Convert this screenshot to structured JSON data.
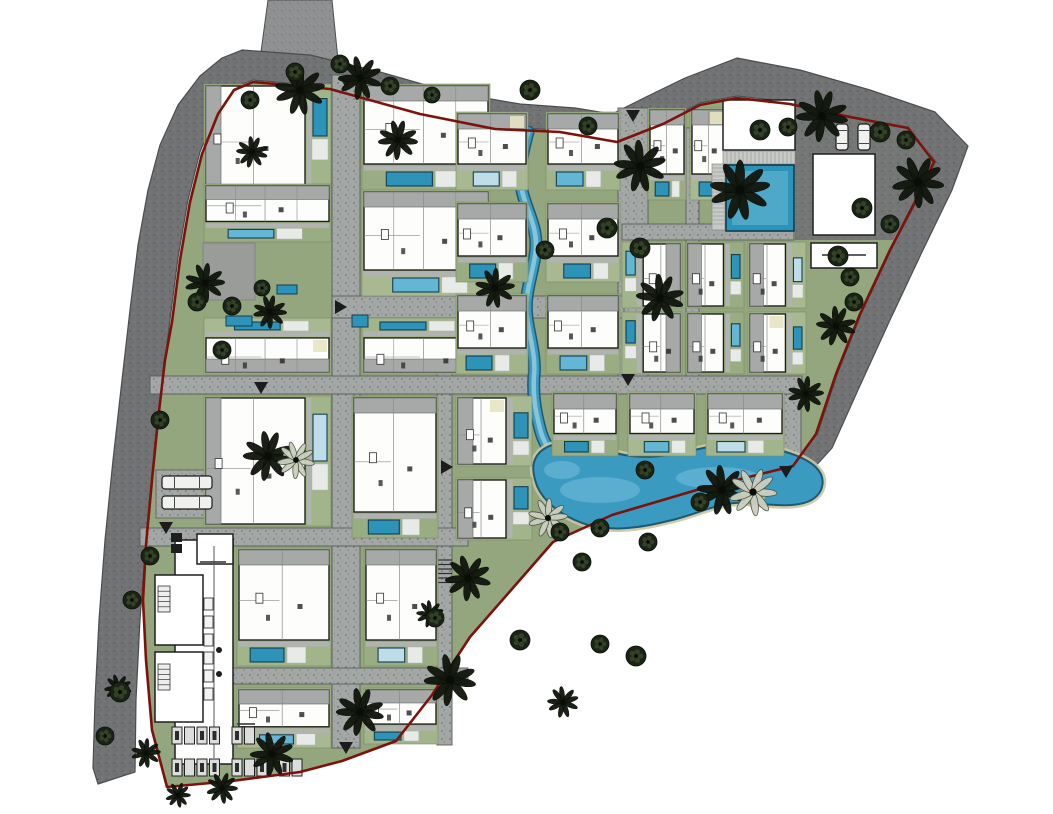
{
  "canvas": {
    "w": 1053,
    "h": 814
  },
  "palette": {
    "bg": "#ffffff",
    "ring_base": "#717374",
    "ring_dot1": "#5a5c5d",
    "ring_dot2": "#818384",
    "ring_edge": "#4b4d4e",
    "entry_base": "#8f9192",
    "entry_dot": "#7b7d7e",
    "road_base": "#a3a7a5",
    "road_dot1": "#6d7170",
    "road_dot2": "#8e928f",
    "road_edge": "#5a5d5b",
    "green": "#93a67e",
    "yard1": "#a2b489",
    "yard2": "#9aad82",
    "yard3": "#a8b890",
    "boundary_red": "#7d120c",
    "villa_fill": "#fdfdfb",
    "villa_edge": "#1f1f1f",
    "wall": "#8a8a8a",
    "furniture": "#2f2f2f",
    "roof": "#a6a9a7",
    "roof_line": "#6e7270",
    "terrace": "#b0b3b0",
    "terrace_tick": "#8a8d89",
    "pool_deep": "#2e93b8",
    "pool_mid": "#64b7d4",
    "pool_pale": "#bfdde8",
    "pool_edge": "#123f54",
    "deck": "#e7eae6",
    "beige": "#e8e3c2",
    "stream_edge": "#1a5a74",
    "stream": "#3b9ac0",
    "stream_hi": "#8fcade",
    "sand": "#cdc5a2",
    "lagoon_hi": "#77bfdb",
    "island_green": "#8fa377",
    "tree_dark": "#12170e",
    "tree_stroke": "#060904",
    "tree_speck": "#39492c",
    "palm_light": "#c9cfbf",
    "palm_light_edge": "#4a5240",
    "patch_gray": "#9a9c99",
    "white": "#ffffff",
    "car_fill": "#f0f0ef",
    "car_edge": "#1c1c1c",
    "arrow": "#1c1c1c",
    "label_ink": "#3a3a3a",
    "stall_fill": "#dcdedb",
    "stall_edge": "#222222",
    "stall_car": "#2c2c2c"
  },
  "perimeter": {
    "ring": [
      [
        98,
        784
      ],
      [
        93,
        768
      ],
      [
        95,
        700
      ],
      [
        99,
        620
      ],
      [
        105,
        540
      ],
      [
        113,
        460
      ],
      [
        122,
        380
      ],
      [
        130,
        310
      ],
      [
        138,
        245
      ],
      [
        148,
        190
      ],
      [
        160,
        145
      ],
      [
        178,
        105
      ],
      [
        200,
        76
      ],
      [
        222,
        58
      ],
      [
        242,
        50
      ],
      [
        310,
        55
      ],
      [
        380,
        72
      ],
      [
        450,
        92
      ],
      [
        520,
        104
      ],
      [
        575,
        108
      ],
      [
        612,
        114
      ],
      [
        648,
        96
      ],
      [
        685,
        78
      ],
      [
        737,
        58
      ],
      [
        800,
        70
      ],
      [
        870,
        90
      ],
      [
        935,
        112
      ],
      [
        968,
        146
      ],
      [
        952,
        190
      ],
      [
        922,
        252
      ],
      [
        890,
        320
      ],
      [
        858,
        390
      ],
      [
        832,
        448
      ],
      [
        812,
        470
      ],
      [
        795,
        464
      ],
      [
        818,
        432
      ],
      [
        838,
        372
      ],
      [
        862,
        312
      ],
      [
        892,
        248
      ],
      [
        920,
        195
      ],
      [
        936,
        162
      ],
      [
        908,
        126
      ],
      [
        850,
        115
      ],
      [
        790,
        102
      ],
      [
        737,
        96
      ],
      [
        700,
        103
      ],
      [
        663,
        122
      ],
      [
        617,
        140
      ],
      [
        560,
        130
      ],
      [
        495,
        127
      ],
      [
        420,
        112
      ],
      [
        330,
        87
      ],
      [
        253,
        80
      ],
      [
        232,
        88
      ],
      [
        216,
        112
      ],
      [
        200,
        152
      ],
      [
        188,
        200
      ],
      [
        178,
        258
      ],
      [
        170,
        320
      ],
      [
        161,
        392
      ],
      [
        154,
        460
      ],
      [
        146,
        540
      ],
      [
        140,
        620
      ],
      [
        136,
        700
      ],
      [
        135,
        772
      ]
    ],
    "entry": [
      [
        268,
        0
      ],
      [
        332,
        0
      ],
      [
        340,
        80
      ],
      [
        258,
        74
      ]
    ],
    "amenity_patch": [
      [
        795,
        96
      ],
      [
        910,
        124
      ],
      [
        936,
        163
      ],
      [
        893,
        240
      ],
      [
        795,
        240
      ]
    ],
    "utility_patch": [
      203,
      243,
      52,
      57
    ],
    "parking_pad": [
      156,
      470,
      60,
      48
    ]
  },
  "boundary": [
    [
      253,
      82
    ],
    [
      330,
      89
    ],
    [
      420,
      114
    ],
    [
      495,
      129
    ],
    [
      560,
      132
    ],
    [
      617,
      142
    ],
    [
      663,
      124
    ],
    [
      700,
      105
    ],
    [
      737,
      98
    ],
    [
      790,
      104
    ],
    [
      850,
      117
    ],
    [
      908,
      128
    ],
    [
      934,
      162
    ],
    [
      918,
      196
    ],
    [
      890,
      250
    ],
    [
      860,
      314
    ],
    [
      836,
      374
    ],
    [
      816,
      434
    ],
    [
      793,
      466
    ],
    [
      700,
      489
    ],
    [
      612,
      515
    ],
    [
      553,
      542
    ],
    [
      512,
      589
    ],
    [
      470,
      637
    ],
    [
      432,
      695
    ],
    [
      396,
      741
    ],
    [
      342,
      761
    ],
    [
      300,
      772
    ],
    [
      232,
      781
    ],
    [
      167,
      787
    ],
    [
      152,
      730
    ],
    [
      146,
      660
    ],
    [
      143,
      600
    ],
    [
      146,
      545
    ],
    [
      152,
      480
    ],
    [
      158,
      420
    ],
    [
      165,
      360
    ],
    [
      172,
      322
    ],
    [
      180,
      260
    ],
    [
      190,
      202
    ],
    [
      202,
      154
    ],
    [
      218,
      114
    ],
    [
      234,
      90
    ]
  ],
  "roads": [
    [
      332,
      75,
      28,
      673
    ],
    [
      618,
      108,
      30,
      270
    ],
    [
      775,
      377,
      26,
      90
    ],
    [
      437,
      85,
      15,
      660
    ],
    [
      686,
      128,
      13,
      250
    ],
    [
      332,
      296,
      292,
      22
    ],
    [
      622,
      224,
      172,
      16
    ],
    [
      150,
      376,
      652,
      18
    ],
    [
      140,
      528,
      328,
      18
    ],
    [
      228,
      668,
      240,
      16
    ]
  ],
  "ladder": {
    "x": 437,
    "y": 560,
    "w": 15,
    "n": 6,
    "step": 4.5
  },
  "stream": {
    "path": "M528,132 C521,158 517,176 524,198 C530,218 539,232 535,256 C531,280 524,296 527,318 C530,340 536,356 534,376 C533,390 534,402 537,416 C540,430 542,438 547,446"
  },
  "lagoon": {
    "path": "M540,452 C558,436 585,444 612,452 C642,461 666,456 694,450 C724,443 756,442 786,452 C812,460 828,472 821,490 C812,509 782,506 752,503 C720,500 700,514 668,521 C636,529 606,532 582,523 C558,514 543,500 537,486 C532,472 531,461 540,452 Z",
    "island": [
      753,
      495,
      11
    ],
    "highlights": [
      [
        600,
        490,
        40,
        13
      ],
      [
        718,
        478,
        42,
        11
      ],
      [
        562,
        470,
        18,
        9
      ]
    ]
  },
  "villas": [
    [
      204,
      84,
      127,
      104,
      "E"
    ],
    [
      204,
      184,
      127,
      58,
      "S"
    ],
    [
      204,
      318,
      127,
      56,
      "N"
    ],
    [
      204,
      396,
      127,
      130,
      "E"
    ],
    [
      362,
      84,
      128,
      106,
      "S"
    ],
    [
      362,
      190,
      128,
      106,
      "S"
    ],
    [
      362,
      318,
      128,
      56,
      "N"
    ],
    [
      352,
      396,
      86,
      142,
      "S"
    ],
    [
      456,
      112,
      72,
      78,
      "S"
    ],
    [
      546,
      112,
      74,
      78,
      "S"
    ],
    [
      456,
      202,
      72,
      80,
      "S"
    ],
    [
      546,
      202,
      74,
      80,
      "S"
    ],
    [
      456,
      294,
      72,
      80,
      "S"
    ],
    [
      546,
      294,
      74,
      80,
      "S"
    ],
    [
      456,
      396,
      76,
      70,
      "E"
    ],
    [
      456,
      478,
      76,
      62,
      "E"
    ],
    [
      552,
      392,
      66,
      64,
      "S"
    ],
    [
      628,
      392,
      68,
      64,
      "S"
    ],
    [
      706,
      392,
      78,
      64,
      "S"
    ],
    [
      648,
      108,
      38,
      92,
      "S"
    ],
    [
      690,
      108,
      38,
      92,
      "S"
    ],
    [
      622,
      242,
      60,
      66,
      "W"
    ],
    [
      686,
      242,
      58,
      66,
      "E"
    ],
    [
      748,
      242,
      58,
      66,
      "E"
    ],
    [
      622,
      312,
      60,
      62,
      "W"
    ],
    [
      686,
      312,
      58,
      62,
      "E"
    ],
    [
      748,
      312,
      58,
      62,
      "E"
    ],
    [
      237,
      548,
      94,
      118,
      "S"
    ],
    [
      364,
      548,
      74,
      118,
      "S"
    ],
    [
      237,
      688,
      94,
      60,
      "S"
    ],
    [
      364,
      688,
      74,
      56,
      "S"
    ]
  ],
  "loose_pools": [
    [
      277,
      285,
      20,
      9
    ],
    [
      226,
      316,
      26,
      10
    ],
    [
      352,
      315,
      16,
      12
    ]
  ],
  "trees": [
    [
      300,
      90,
      24,
      "p"
    ],
    [
      360,
      78,
      21,
      "p"
    ],
    [
      398,
      140,
      19,
      "p"
    ],
    [
      252,
      152,
      15,
      "p"
    ],
    [
      205,
      283,
      19,
      "p"
    ],
    [
      270,
      312,
      16,
      "p"
    ],
    [
      640,
      166,
      25,
      "p"
    ],
    [
      740,
      190,
      29,
      "p"
    ],
    [
      822,
      116,
      25,
      "p"
    ],
    [
      918,
      182,
      25,
      "p"
    ],
    [
      495,
      288,
      19,
      "p"
    ],
    [
      660,
      298,
      23,
      "p"
    ],
    [
      836,
      326,
      19,
      "p"
    ],
    [
      806,
      394,
      17,
      "p"
    ],
    [
      722,
      490,
      24,
      "p"
    ],
    [
      468,
      578,
      22,
      "p"
    ],
    [
      450,
      680,
      25,
      "p"
    ],
    [
      360,
      712,
      23,
      "p"
    ],
    [
      272,
      754,
      21,
      "p"
    ],
    [
      178,
      795,
      12,
      "p"
    ],
    [
      268,
      456,
      24,
      "p"
    ],
    [
      563,
      702,
      15,
      "p"
    ],
    [
      430,
      614,
      13,
      "p"
    ],
    [
      118,
      688,
      13,
      "p"
    ],
    [
      146,
      753,
      14,
      "p"
    ],
    [
      222,
      788,
      15,
      "p"
    ],
    [
      296,
      460,
      18,
      "w"
    ],
    [
      548,
      518,
      19,
      "w"
    ],
    [
      753,
      492,
      23,
      "w"
    ],
    [
      250,
      100,
      9,
      "s"
    ],
    [
      295,
      72,
      9,
      "s"
    ],
    [
      340,
      64,
      9,
      "s"
    ],
    [
      390,
      86,
      9,
      "s"
    ],
    [
      432,
      95,
      8,
      "s"
    ],
    [
      530,
      90,
      10,
      "s"
    ],
    [
      588,
      126,
      9,
      "s"
    ],
    [
      607,
      228,
      10,
      "s"
    ],
    [
      640,
      248,
      10,
      "s"
    ],
    [
      545,
      250,
      9,
      "s"
    ],
    [
      760,
      130,
      10,
      "s"
    ],
    [
      788,
      127,
      9,
      "s"
    ],
    [
      880,
      132,
      10,
      "s"
    ],
    [
      906,
      140,
      9,
      "s"
    ],
    [
      862,
      208,
      10,
      "s"
    ],
    [
      890,
      224,
      9,
      "s"
    ],
    [
      838,
      256,
      10,
      "s"
    ],
    [
      850,
      277,
      9,
      "s"
    ],
    [
      854,
      302,
      9,
      "s"
    ],
    [
      645,
      470,
      9,
      "s"
    ],
    [
      600,
      528,
      9,
      "s"
    ],
    [
      560,
      532,
      9,
      "s"
    ],
    [
      648,
      542,
      9,
      "s"
    ],
    [
      700,
      502,
      9,
      "s"
    ],
    [
      435,
      618,
      9,
      "s"
    ],
    [
      520,
      640,
      10,
      "s"
    ],
    [
      600,
      644,
      9,
      "s"
    ],
    [
      636,
      656,
      10,
      "s"
    ],
    [
      582,
      562,
      9,
      "s"
    ],
    [
      222,
      350,
      9,
      "s"
    ],
    [
      160,
      420,
      9,
      "s"
    ],
    [
      150,
      556,
      9,
      "s"
    ],
    [
      132,
      600,
      9,
      "s"
    ],
    [
      120,
      692,
      10,
      "s"
    ],
    [
      105,
      736,
      9,
      "s"
    ],
    [
      197,
      302,
      9,
      "s"
    ],
    [
      232,
      306,
      9,
      "s"
    ],
    [
      262,
      288,
      8,
      "s"
    ]
  ],
  "reception": {
    "hall": [
      175,
      540,
      58,
      224
    ],
    "top_room": [
      197,
      534,
      36,
      30
    ],
    "wings": [
      [
        155,
        575,
        48,
        70
      ],
      [
        155,
        652,
        48,
        70
      ]
    ],
    "stairs": [
      [
        158,
        586,
        12,
        26
      ],
      [
        158,
        664,
        12,
        26
      ]
    ],
    "corridor_x": 214,
    "desks": {
      "x": 204,
      "y0": 598,
      "n": 6,
      "step": 18
    },
    "dots": [
      [
        219,
        650
      ],
      [
        219,
        674
      ]
    ],
    "bins": [
      [
        171,
        533,
        11,
        9
      ],
      [
        171,
        544,
        11,
        9
      ]
    ]
  },
  "parking": {
    "stall_w": 10,
    "stall_h": 17,
    "gap": 2.5,
    "group_gap": 10,
    "rows": [
      {
        "x": 172,
        "y": 727,
        "groups": [
          4,
          2
        ]
      },
      {
        "x": 172,
        "y": 759,
        "groups": [
          4,
          3,
          2
        ]
      }
    ]
  },
  "amenity": {
    "bldg_a": [
      723,
      100,
      72,
      50
    ],
    "deck_a": [
      723,
      151,
      72,
      13
    ],
    "side_deck": [
      712,
      164,
      13,
      66
    ],
    "pool": [
      726,
      165,
      68,
      66
    ],
    "bldg_b": [
      813,
      154,
      62,
      81
    ],
    "bldg_c": [
      811,
      243,
      66,
      25
    ]
  },
  "cars": [
    [
      162,
      476,
      50,
      13
    ],
    [
      162,
      496,
      50,
      13
    ],
    [
      836,
      124,
      12,
      26
    ],
    [
      858,
      124,
      12,
      26
    ]
  ],
  "arrows": [
    [
      346,
      82,
      "down"
    ],
    [
      633,
      116,
      "down"
    ],
    [
      166,
      528,
      "down"
    ],
    [
      447,
      467,
      "right"
    ],
    [
      628,
      380,
      "down"
    ],
    [
      786,
      472,
      "down"
    ],
    [
      346,
      748,
      "down"
    ],
    [
      341,
      307,
      "right"
    ],
    [
      261,
      388,
      "down"
    ]
  ],
  "micro_labels": [
    [
      822,
      255,
      44
    ],
    [
      200,
      562,
      26
    ],
    [
      237,
      724,
      18
    ]
  ]
}
